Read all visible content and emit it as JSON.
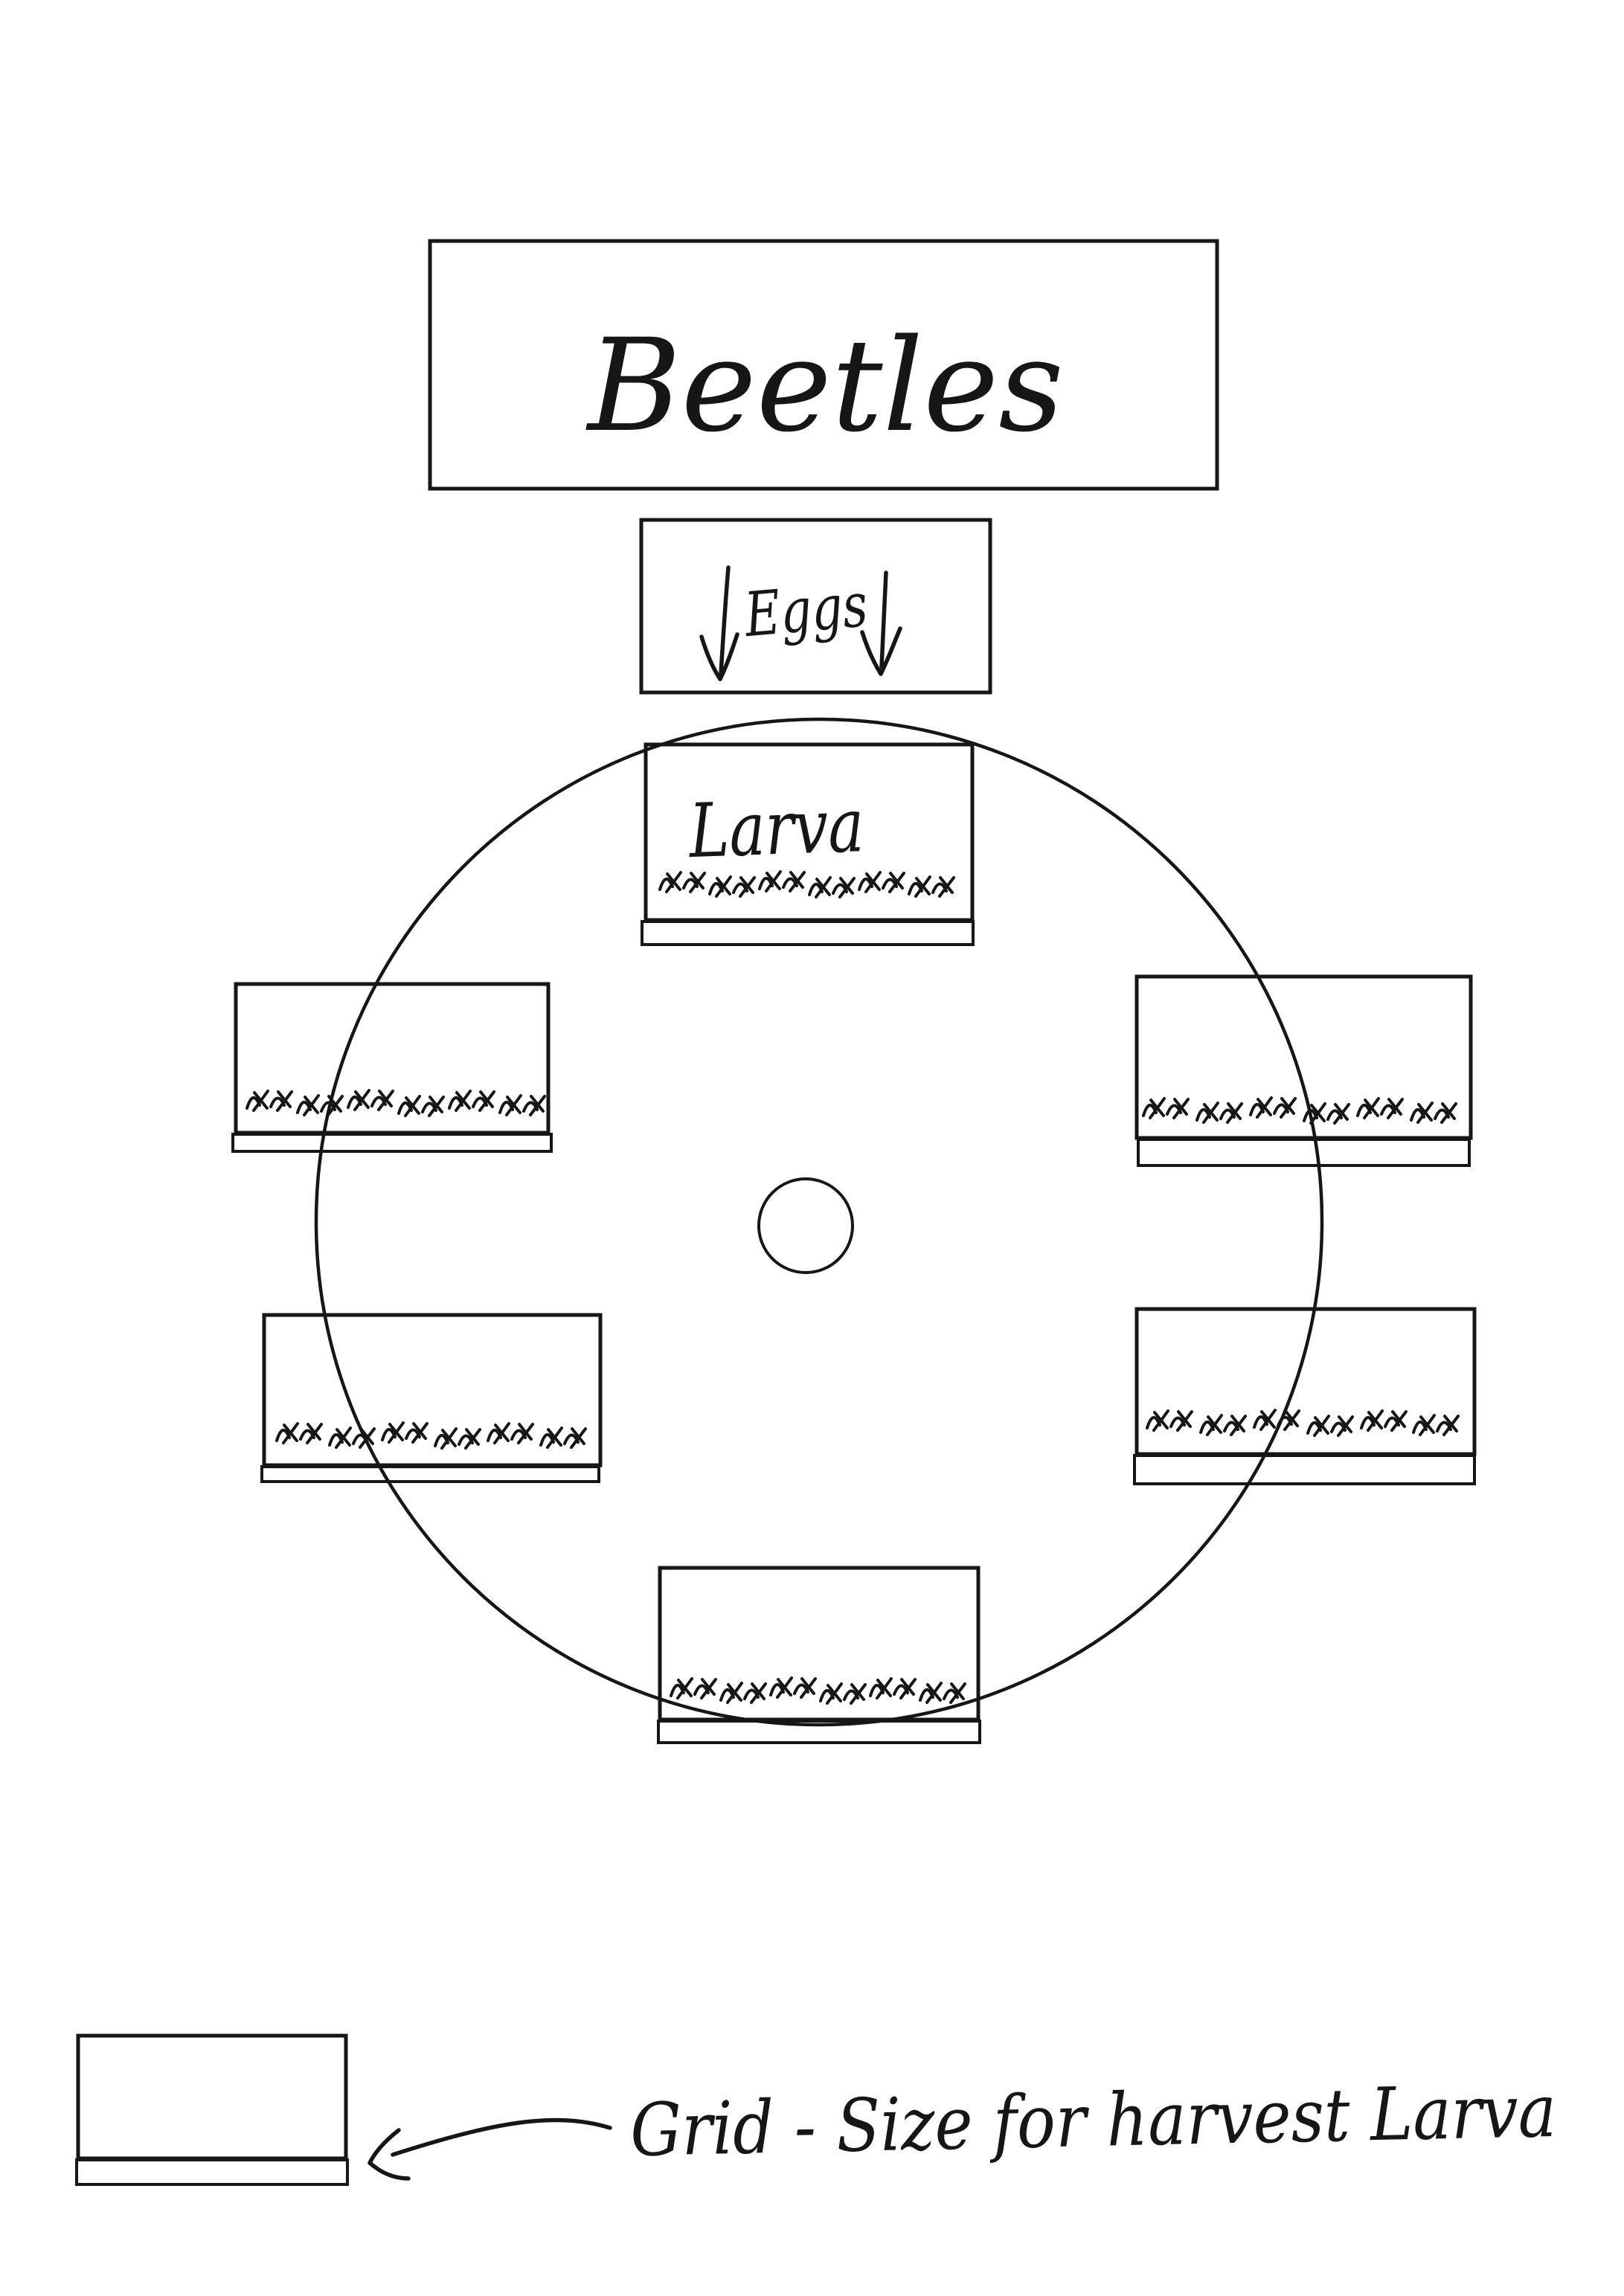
{
  "canvas": {
    "background_color": "#ffffff",
    "ink_color": "#161616"
  },
  "title_box": {
    "label": "Beetles"
  },
  "eggs_box": {
    "label": "Eggs",
    "icons": [
      "down-arrow",
      "down-arrow"
    ]
  },
  "cycle": {
    "larva_box": {
      "label": "Larva"
    }
  },
  "legend": {
    "caption": "Grid - Size for harvest Larva",
    "icon": "arrow-pointing-left"
  }
}
